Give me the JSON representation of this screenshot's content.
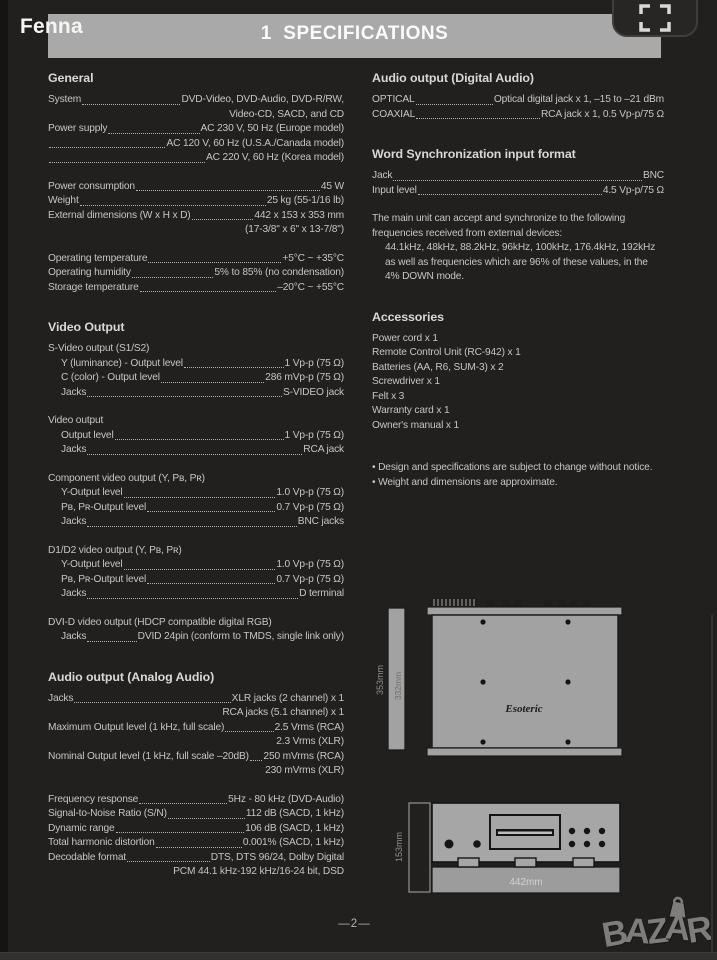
{
  "colors": {
    "page_bg": "#22201e",
    "header_bar": "#a9a9a9",
    "body_text": "#c7c5c3",
    "diagram_gray": "#a4a4a4",
    "brand_gray": "#7e7d7c"
  },
  "header": {
    "viewer_label": "Fenna",
    "title": "1  SPECIFICATIONS"
  },
  "left_column": {
    "sections": [
      {
        "heading": "General",
        "lines": [
          {
            "l": "System",
            "v": "DVD-Video, DVD-Audio, DVD-R/RW,"
          },
          {
            "v": "Video-CD, SACD, and CD"
          },
          {
            "l": "Power supply",
            "v": "AC 230 V, 50 Hz (Europe model)"
          },
          {
            "l": "",
            "v": "AC 120 V, 60 Hz (U.S.A./Canada model)"
          },
          {
            "l": "",
            "v": "AC 220 V, 60 Hz (Korea model)"
          },
          {
            "sp": true
          },
          {
            "l": "Power consumption",
            "v": "45 W"
          },
          {
            "l": "Weight",
            "v": "25 kg (55-1/16 lb)"
          },
          {
            "l": "External dimensions (W x H x D)",
            "v": "442 x 153 x 353 mm"
          },
          {
            "v": "(17-3/8\" x 6\" x 13-7/8\")"
          },
          {
            "sp": true
          },
          {
            "l": "Operating temperature",
            "v": "+5°C ~ +35°C"
          },
          {
            "l": "Operating humidity",
            "v": "5% to 85% (no condensation)"
          },
          {
            "l": "Storage temperature",
            "v": "–20°C ~ +55°C"
          }
        ]
      },
      {
        "heading": "Video Output",
        "lines": [
          {
            "t": "S-Video output (S1/S2)"
          },
          {
            "l": "Y (luminance) - Output level",
            "v": "1 Vp-p (75 Ω)",
            "i": 1
          },
          {
            "l": "C (color) - Output level",
            "v": "286 mVp-p (75 Ω)",
            "i": 1
          },
          {
            "l": "Jacks",
            "v": "S-VIDEO jack",
            "i": 1
          },
          {
            "sp": true
          },
          {
            "t": "Video output"
          },
          {
            "l": "Output level",
            "v": "1 Vp-p (75 Ω)",
            "i": 1
          },
          {
            "l": "Jacks",
            "v": "RCA jack",
            "i": 1
          },
          {
            "sp": true
          },
          {
            "t": "Component video output (Y, Pʙ, Pʀ)"
          },
          {
            "l": "Y-Output level",
            "v": "1.0 Vp-p (75 Ω)",
            "i": 1
          },
          {
            "l": "Pʙ, Pʀ-Output level",
            "v": "0.7 Vp-p (75 Ω)",
            "i": 1
          },
          {
            "l": "Jacks",
            "v": "BNC jacks",
            "i": 1
          },
          {
            "sp": true
          },
          {
            "t": "D1/D2 video output (Y, Pʙ, Pʀ)"
          },
          {
            "l": "Y-Output level",
            "v": "1.0 Vp-p (75 Ω)",
            "i": 1
          },
          {
            "l": "Pʙ, Pʀ-Output level",
            "v": "0.7 Vp-p (75 Ω)",
            "i": 1
          },
          {
            "l": "Jacks",
            "v": "D terminal",
            "i": 1
          },
          {
            "sp": true
          },
          {
            "t": "DVI-D video output (HDCP compatible digital RGB)"
          },
          {
            "l": "Jacks",
            "v": "DVID 24pin (conform to TMDS, single link only)",
            "i": 1
          }
        ]
      },
      {
        "heading": "Audio output (Analog Audio)",
        "lines": [
          {
            "l": "Jacks",
            "v": "XLR jacks (2 channel) x 1"
          },
          {
            "v": "RCA jacks (5.1 channel) x 1"
          },
          {
            "l": "Maximum Output level (1 kHz, full scale)",
            "v": "2.5 Vrms (RCA)"
          },
          {
            "v": "2.3 Vrms (XLR)"
          },
          {
            "l": "Nominal Output level (1 kHz, full scale –20dB)",
            "v": "250 mVrms (RCA)"
          },
          {
            "v": "230 mVrms (XLR)"
          },
          {
            "sp": true
          },
          {
            "l": "Frequency response",
            "v": "5Hz - 80 kHz (DVD-Audio)"
          },
          {
            "l": "Signal-to-Noise Ratio (S/N)",
            "v": "112 dB (SACD, 1 kHz)"
          },
          {
            "l": "Dynamic range",
            "v": "106 dB (SACD, 1 kHz)"
          },
          {
            "l": "Total harmonic distortion",
            "v": "0.001% (SACD, 1 kHz)"
          },
          {
            "l": "Decodable format",
            "v": "DTS, DTS 96/24, Dolby Digital"
          },
          {
            "v": "PCM 44.1 kHz-192 kHz/16-24 bit, DSD"
          }
        ]
      }
    ]
  },
  "right_column": {
    "sections": [
      {
        "heading": "Audio output (Digital Audio)",
        "lines": [
          {
            "l": "OPTICAL",
            "v": "Optical digital jack x 1, –15 to –21 dBm"
          },
          {
            "l": "COAXIAL",
            "v": "RCA jack x 1, 0.5 Vp-p/75 Ω"
          }
        ]
      },
      {
        "heading": "Word Synchronization input format",
        "lines": [
          {
            "l": "Jack",
            "v": "BNC"
          },
          {
            "l": "Input level",
            "v": "4.5 Vp-p/75 Ω"
          },
          {
            "sp": true
          },
          {
            "t": "The main unit can accept and synchronize to the following"
          },
          {
            "t": "frequencies received from external devices:"
          },
          {
            "t": "44.1kHz, 48kHz, 88.2kHz, 96kHz, 100kHz, 176.4kHz, 192kHz",
            "i": 1
          },
          {
            "t": "as well as frequencies which are 96% of these values, in the",
            "i": 1
          },
          {
            "t": "4% DOWN mode.",
            "i": 1
          }
        ]
      },
      {
        "heading": "Accessories",
        "lines": [
          {
            "t": "Power cord x 1"
          },
          {
            "t": "Remote Control Unit (RC-942) x 1"
          },
          {
            "t": "Batteries (AA, R6, SUM-3) x 2"
          },
          {
            "t": "Screwdriver x 1"
          },
          {
            "t": "Felt x 3"
          },
          {
            "t": "Warranty card x 1"
          },
          {
            "t": "Owner's manual x 1"
          },
          {
            "sp": true
          },
          {
            "sp": true
          },
          {
            "t": "• Design and specifications are subject to change without notice."
          },
          {
            "t": "• Weight and dimensions are approximate."
          }
        ]
      }
    ]
  },
  "diagrams": {
    "brand": "Esoteric",
    "top_view": {
      "height_label": "353mm",
      "inner_height_label": "332mm"
    },
    "front_view": {
      "height_label": "153mm",
      "width_label": "442mm"
    }
  },
  "footer": {
    "page_number": "—2—",
    "brand": "BAZAR",
    "brand_letters": [
      "B",
      "A",
      "Z",
      "A",
      "R"
    ]
  }
}
